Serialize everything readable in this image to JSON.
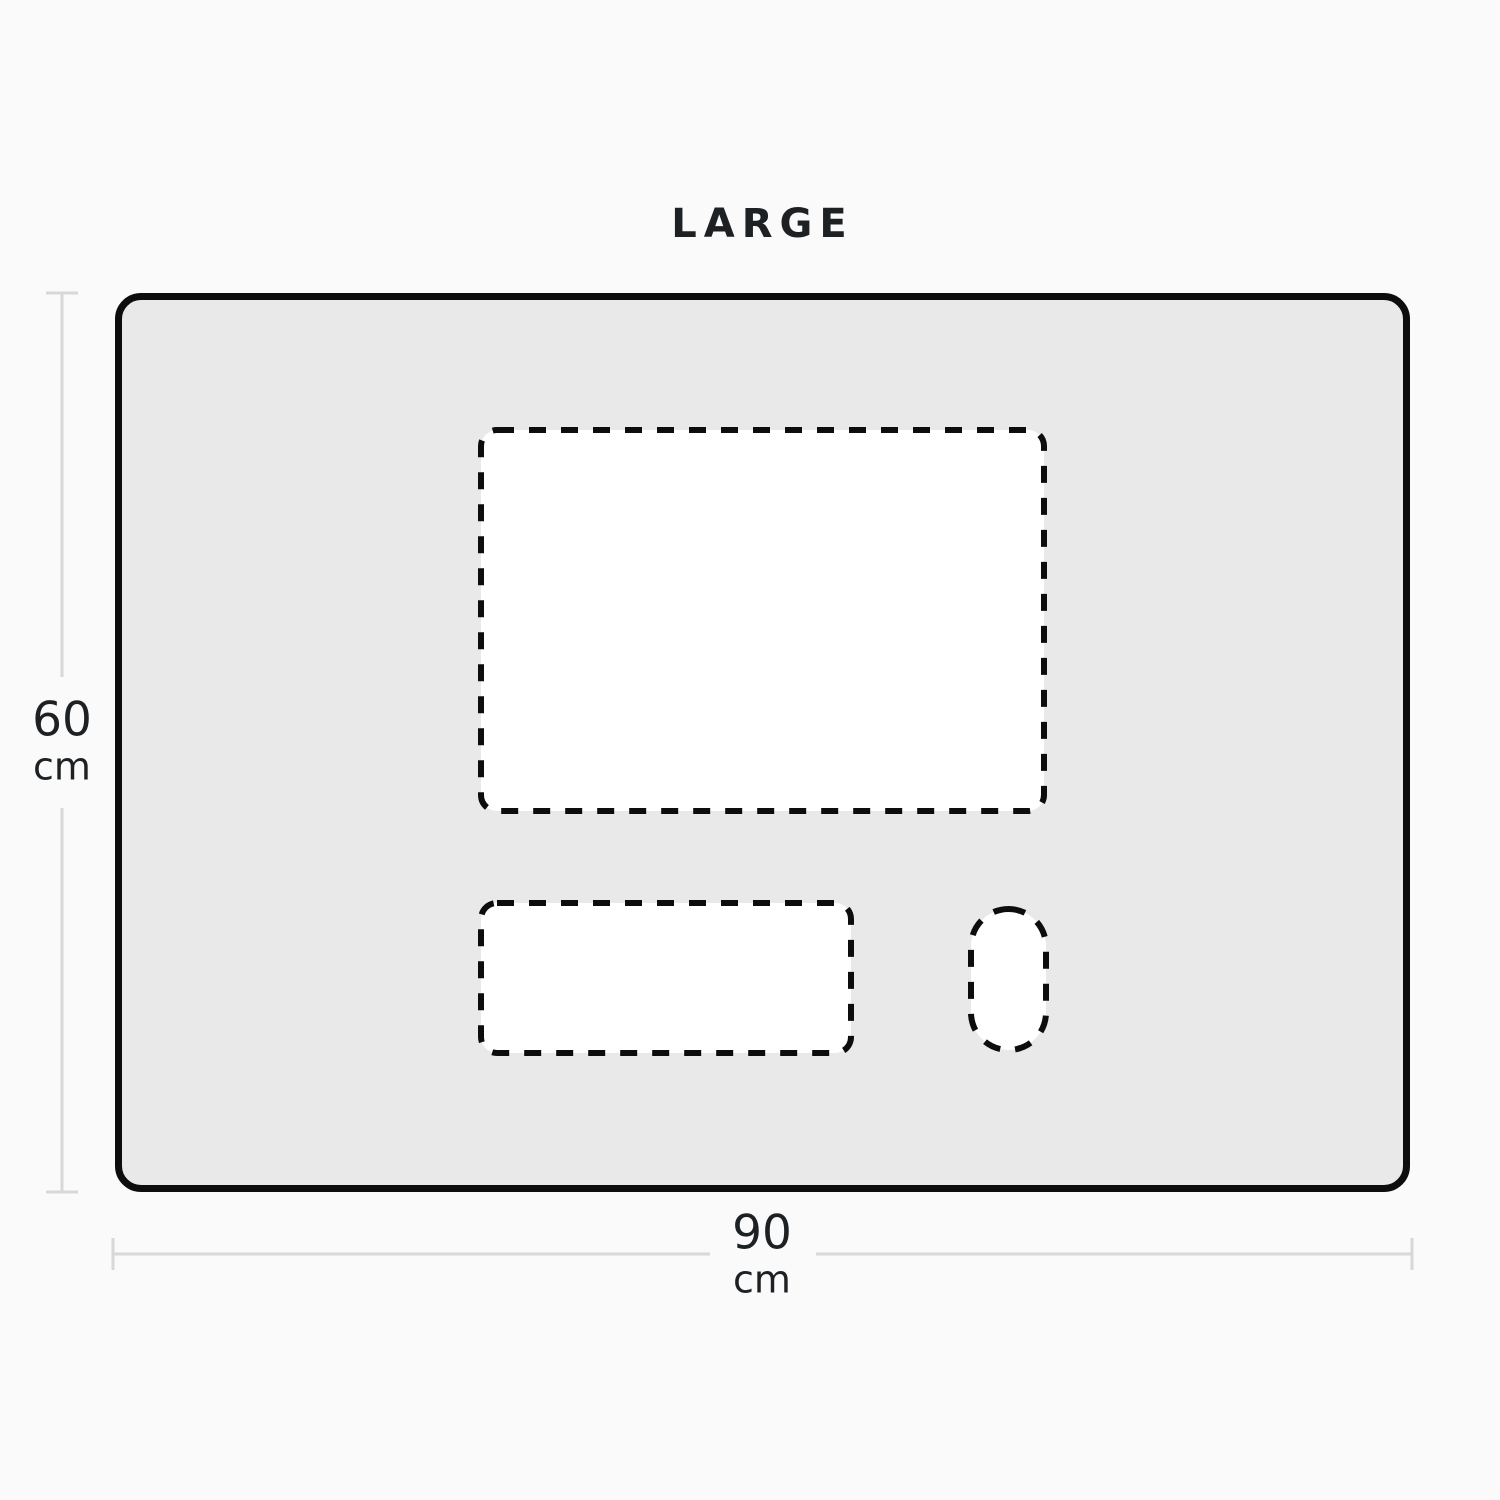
{
  "title": "LARGE",
  "mat": {
    "height_label": {
      "value": "60",
      "unit": "cm"
    },
    "width_label": {
      "value": "90",
      "unit": "cm"
    }
  },
  "shapes": [
    {
      "name": "monitor-area"
    },
    {
      "name": "keyboard-area"
    },
    {
      "name": "mouse-area"
    }
  ],
  "colors": {
    "background": "#fafafa",
    "mat_fill": "#e9e9e9",
    "outline": "#0d0d0d",
    "shape_fill": "#ffffff",
    "dimension_line": "#d8d8d8",
    "text": "#1e2124"
  }
}
